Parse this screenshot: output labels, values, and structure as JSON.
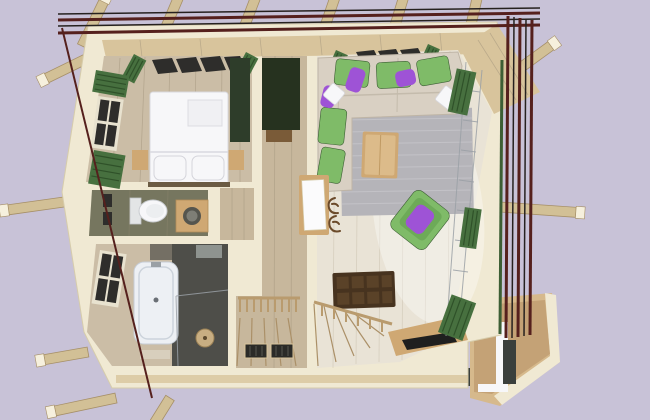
{
  "scene": {
    "type": "3d-floor-plan-render",
    "view": "top-down cutaway of a timber house upper floor",
    "background": "plain lavender",
    "rooms": [
      {
        "name": "bedroom",
        "position": "top-left",
        "furniture": [
          "double-bed-white",
          "folded-blanket",
          "two-pillows",
          "nightstand-left",
          "nightstand-right",
          "green-shutter-window-left-wall",
          "skylight-row-top-wall",
          "dark-green-cabinet"
        ]
      },
      {
        "name": "wc",
        "position": "middle-left",
        "furniture": [
          "toilet",
          "wood-vanity-with-round-sink",
          "wall-pictures"
        ]
      },
      {
        "name": "bathroom",
        "position": "bottom-left",
        "furniture": [
          "bathtub-white",
          "shower-corner-dark-tile",
          "round-shower-head",
          "window-left-wall",
          "small-sink"
        ]
      },
      {
        "name": "hallway",
        "position": "center",
        "furniture": [
          "dark-wardrobe",
          "closet-niche",
          "winder-staircase",
          "railing-balusters",
          "two-floor-grates"
        ]
      },
      {
        "name": "living-room",
        "position": "right",
        "furniture": [
          "l-shaped-beige-sofa",
          "green-seat-cushions",
          "purple-pillows",
          "white-pillows",
          "grey-rug",
          "wood-coffee-table",
          "green-armchair-purple-pillow",
          "dark-brown-chest",
          "window-bench",
          "black-tray",
          "white-entry-door",
          "antler-coat-rack",
          "slanted-glass-wall",
          "green-planter-boxes",
          "stair-flight-down"
        ]
      },
      {
        "name": "balcony",
        "position": "bottom-right",
        "furniture": [
          "wood-deck",
          "dark-column",
          "white-corner-wall"
        ]
      }
    ],
    "exterior": [
      "roof-rafters-top",
      "roof-rafters-left",
      "roof-rafters-right",
      "maroon-roof-edge-lines-top",
      "maroon-roof-edge-lines-right",
      "maroon-roof-edge-line-left"
    ]
  },
  "colors": {
    "background": "#c8c2d7",
    "wallCream": "#f0e9d3",
    "wallEdge": "#d6ccab",
    "woodBand": "#d8c49c",
    "woodBeam": "#d2c096",
    "beamCap": "#f6f0dd",
    "beamShade": "#a68f67",
    "floorBedroom": "#cbbda6",
    "floorHall": "#c7b79c",
    "floorLiving": "#e9e3d6",
    "plankLine": "#a3957d",
    "roofLineMaroon": "#55201d",
    "roofLineBlack": "#26211f",
    "greenShutter": "#47703f",
    "greenShutterDark": "#2f5129",
    "greenDark": "#3c5e34",
    "greenBright": "#7fbb68",
    "purple": "#9e53d6",
    "sofaBeige": "#d9d0c3",
    "rug": "#b5b4b9",
    "white": "#f7f7f9",
    "tileOlive": "#76765f",
    "tileDark": "#4e4e49",
    "tubWhite": "#edf0f4",
    "tubEdge": "#c6cdd6",
    "tableWood": "#cfa873",
    "tableTopWood": "#dcbb8a",
    "chestBrown": "#47331f",
    "chestCell": "#5a4228",
    "stairWood": "#b99b6e",
    "paneDark": "#2e2d2b",
    "windowFrame": "#e8e2cf",
    "grateDark": "#2b2b28",
    "doorWhite": "#fbfbfc",
    "antler": "#6b4a2a",
    "trayBlack": "#1f1f1f",
    "glassLine": "#9aa0a6",
    "balconyWood": "#d6b98c",
    "columnDark": "#3a3f3c",
    "sunGlare": "#ffffff"
  }
}
